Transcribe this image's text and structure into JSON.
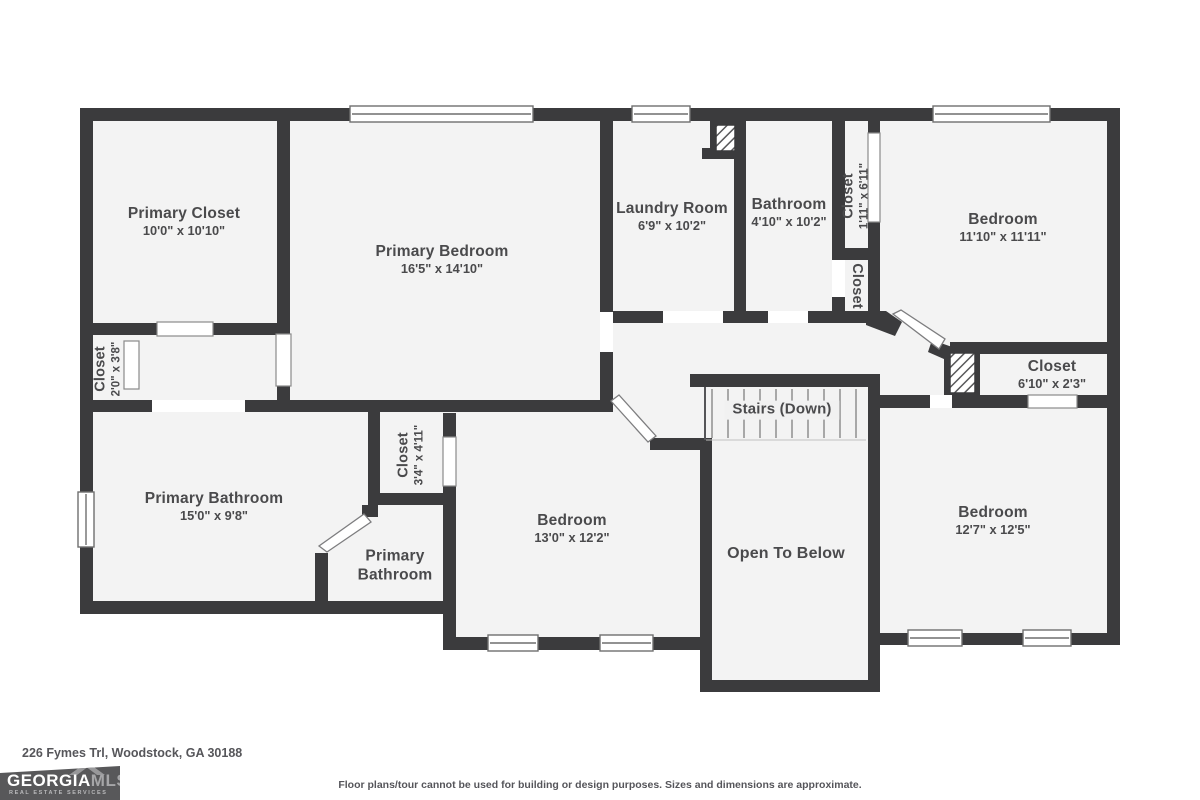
{
  "plan": {
    "rooms": [
      {
        "name": "Primary Closet",
        "dims": "10'0\" x 10'10\""
      },
      {
        "name": "Primary Bedroom",
        "dims": "16'5\" x 14'10\""
      },
      {
        "name": "Laundry Room",
        "dims": "6'9\" x 10'2\""
      },
      {
        "name": "Bathroom",
        "dims": "4'10\" x 10'2\""
      },
      {
        "name": "Closet",
        "dims": "1'11\" x 6'11\""
      },
      {
        "name": "Closet",
        "dims": ""
      },
      {
        "name": "Bedroom",
        "dims": "11'10\" x 11'11\""
      },
      {
        "name": "Closet",
        "dims": "6'10\" x 2'3\""
      },
      {
        "name": "Closet",
        "dims": "2'0\" x 3'8\""
      },
      {
        "name": "Primary Bathroom",
        "dims": "15'0\" x 9'8\""
      },
      {
        "name": "Closet",
        "dims": "3'4\" x 4'11\""
      },
      {
        "name": "Primary Bathroom",
        "dims": ""
      },
      {
        "name": "Bedroom",
        "dims": "13'0\" x 12'2\""
      },
      {
        "name": "Stairs (Down)",
        "dims": ""
      },
      {
        "name": "Open To Below",
        "dims": ""
      },
      {
        "name": "Bedroom",
        "dims": "12'7\" x 12'5\""
      }
    ],
    "footer": {
      "address": "226 Fymes Trl, Woodstock, GA 30188",
      "disclaimer": "Floor plans/tour cannot be used for building or design purposes. Sizes and dimensions are approximate."
    },
    "logo": {
      "brand_primary": "GEORGIA",
      "brand_secondary": "MLS",
      "tagline": "REAL ESTATE SERVICES"
    },
    "colors": {
      "wall": "#3b3b3d",
      "floor": "#f3f3f3",
      "label": "#4a4a4c",
      "logo_bg": "#58585a"
    }
  }
}
